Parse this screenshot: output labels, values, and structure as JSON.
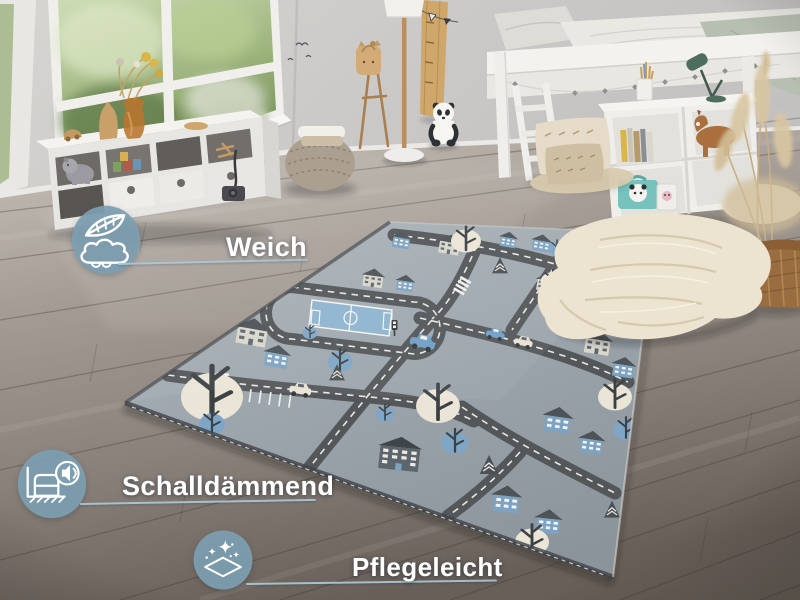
{
  "callouts": {
    "badge_color": "#7d9fb1",
    "line_color": "#abc9d7",
    "text_color": "#ffffff",
    "items": [
      {
        "id": "soft",
        "label": "Weich",
        "icon": "feather-cloud-icon"
      },
      {
        "id": "sound-dampening",
        "label": "Schalldämmend",
        "icon": "sound-dampening-icon"
      },
      {
        "id": "easy-care",
        "label": "Pflegeleicht",
        "icon": "sparkle-clean-icon"
      }
    ]
  },
  "scene": {
    "subject": "kids room with grey city road play rug",
    "objects": [
      "window-with-greenery",
      "white-cube-storage-shelf",
      "hippo-plush",
      "amber-vase-dried-flowers",
      "knitted-pouf",
      "floor-lamp",
      "coat-rack-bag",
      "growth-chart",
      "pennant-garland",
      "panda-plush",
      "white-loft-bed",
      "bed-ladder",
      "desk-cube-shelf",
      "books",
      "horse-plush",
      "panda-suitcase",
      "green-desk-lamp",
      "floor-cushions",
      "jute-mat",
      "wicker-basket",
      "pampas-grass",
      "chunky-knit-blanket",
      "city-play-rug"
    ],
    "palette": {
      "wall": "#cfcecb",
      "floor_light": "#c4beb7",
      "floor_dark": "#6b625a",
      "rug_base": "#9ba4ab",
      "rug_road": "#53575a",
      "rug_blue": "#7fa6c6",
      "rug_cream": "#eae5d6",
      "window_green": "#7d9a63",
      "wood": "#b98f5e",
      "basket": "#9a6d40",
      "blanket": "#ece4d0"
    }
  }
}
